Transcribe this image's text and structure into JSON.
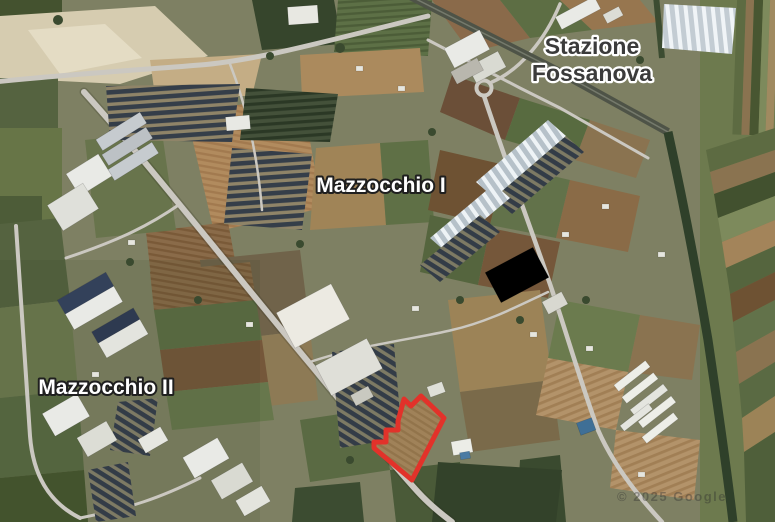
{
  "map": {
    "labels": {
      "station_line1": "Stazione",
      "station_line2": "Fossanova",
      "district_i": "Mazzocchio I",
      "district_ii": "Mazzocchio II"
    },
    "parcel": {
      "points": "404,399 411,406 421,396 444,418 412,480 374,448 374,442 386,442 386,430 398,430 398,421",
      "color": "#e2322a",
      "stroke_width": "5"
    },
    "watermark": "© 2025 Google",
    "colors": {
      "label_dark_text": "#3b3b3b",
      "label_dark_halo": "#ffffff",
      "label_light_text": "#ffffff",
      "label_light_halo": "#1f1f1f",
      "parcel_red": "#e2322a",
      "road_gray": "#cbc8c1",
      "solar_panel_dark": "#353e49",
      "canal_green": "#2f402a",
      "field_tan": "#b18b5e"
    }
  }
}
